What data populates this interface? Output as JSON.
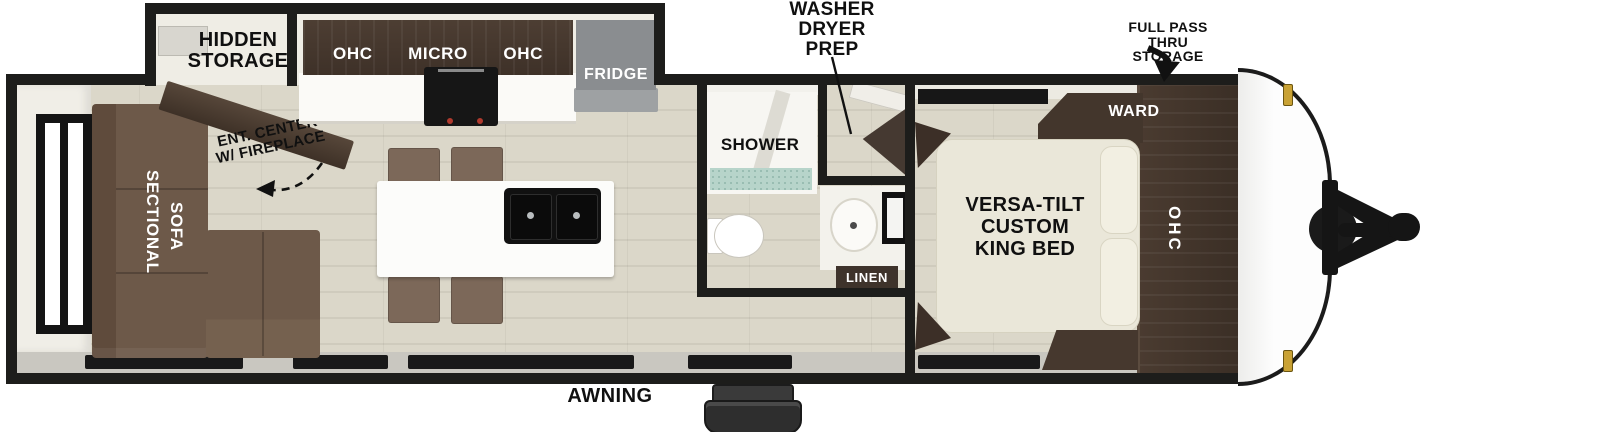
{
  "plan": {
    "title": "Travel trailer floor plan",
    "labels": {
      "hidden1": "HIDDEN",
      "hidden2": "STORAGE",
      "ohc_left": "OHC",
      "micro": "MICRO",
      "ohc_right": "OHC",
      "fridge": "FRIDGE",
      "washer1": "WASHER",
      "washer2": "DRYER",
      "washer3": "PREP",
      "pass1": "FULL PASS THRU",
      "pass2": "STORAGE",
      "ward": "WARD",
      "ohc_bed": "OHC",
      "bed1": "VERSA-TILT",
      "bed2": "CUSTOM",
      "bed3": "KING BED",
      "shower": "SHOWER",
      "linen": "LINEN",
      "ent1": "ENT. CENTER",
      "ent2": "W/ FIREPLACE",
      "sectional": "SECTIONAL",
      "sofa": "SOFA",
      "awning": "AWNING"
    },
    "colors": {
      "wall": "#1d1d1b",
      "floor": "#d9d5c7",
      "cabinet_dark": "#46382e",
      "sofa_brown": "#6d5949",
      "chair_brown": "#7c6859",
      "bed_cream": "#eae7d9",
      "fridge_gray": "#8a8d90",
      "shower_teal": "#b7d4ca",
      "marker_gold": "#c9a235"
    }
  }
}
